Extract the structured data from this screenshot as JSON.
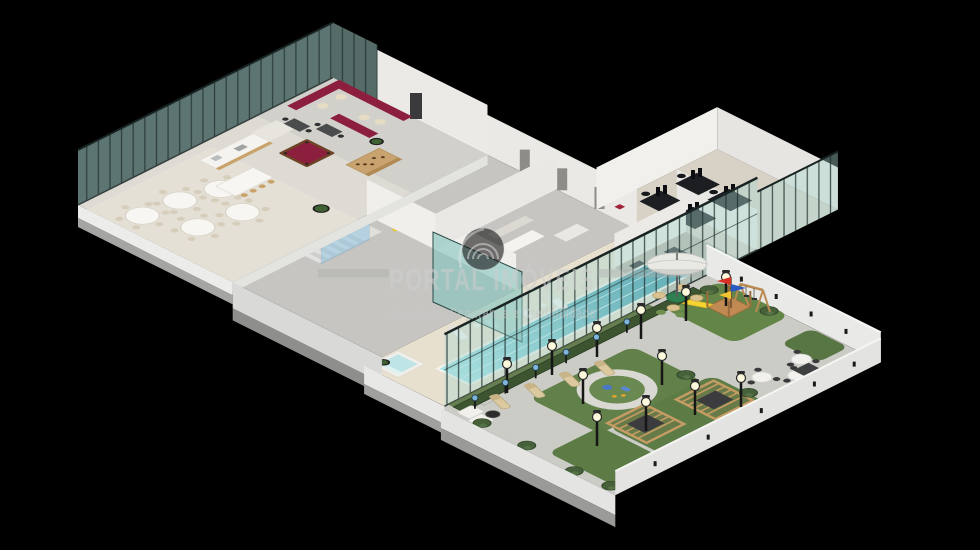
{
  "watermark": {
    "title": "PORTAL IMÓVEIS",
    "tagline": "Seriedade, Segurança e Credibilidade"
  },
  "scene": {
    "type": "3d-isometric-floorplan-render",
    "background": "#000000"
  },
  "colors": {
    "background": "#000000",
    "glass": "#a9d6d0",
    "glass_frame": "#20302e",
    "slab": "#ececea",
    "slab_shadow": "#9a9a98",
    "floor_hall": "#dedbd4",
    "floor_gray": "#c6c5c1",
    "deck": "#e7e0cf",
    "terrace": "#ccccc7",
    "lawn": "#62814a",
    "hedge": "#3d5431",
    "pool_light": "#a6e4e8",
    "pool_deep": "#2e8fa3",
    "accent_maroon": "#8c1f3e",
    "wood": "#c9a36f",
    "wood_dark": "#b98a52",
    "slide_yellow": "#f5d330",
    "flag_red": "#d93025",
    "flag_blue": "#2b59c3",
    "flag_yellow": "#f2c230",
    "furniture_dark": "#1c1e22",
    "white": "#f4f3ef",
    "watermark_text": "#cfcfcf"
  }
}
